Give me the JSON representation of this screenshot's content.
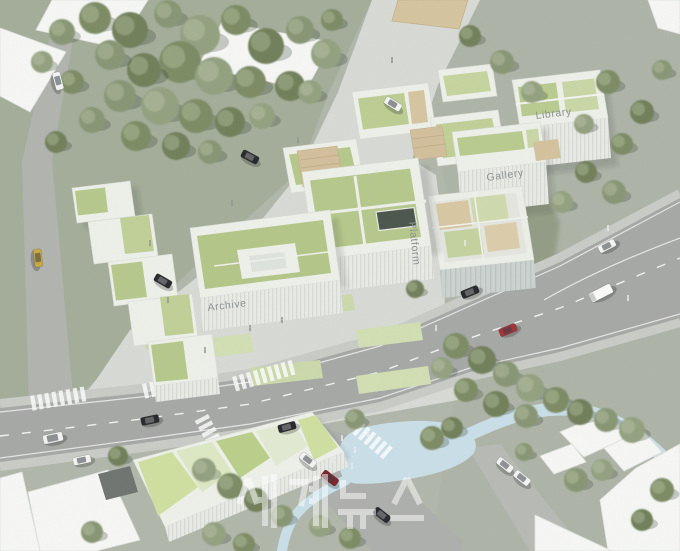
{
  "labels": {
    "library": "Library",
    "gallery": "Gallery",
    "platform": "Platform",
    "archive": "Archive"
  },
  "watermark": {
    "text": "세계뉴스",
    "color": "#ffffff"
  },
  "palette": {
    "ground": "#b2b8ac",
    "grass_upper_left": "#a3ad99",
    "plaza_paving": "#d8dad5",
    "asphalt": "#a6a8a6",
    "water": "#c9dfe8",
    "roof_green": "#b5c88a",
    "roof_green_light": "#cfe0a0",
    "building_white": "#f7f8f6",
    "wood_deck": "#d3c29c",
    "tree_green": "#7b8a64",
    "car_red": "#a33036",
    "car_dark_red": "#7d2127",
    "car_yellow": "#c8a83e",
    "label_gray": "#8c9190",
    "watermark_white": "#ffffff"
  },
  "scene": {
    "trees": [
      [
        95,
        18,
        16
      ],
      [
        130,
        30,
        18
      ],
      [
        168,
        14,
        14
      ],
      [
        200,
        35,
        20
      ],
      [
        236,
        20,
        15
      ],
      [
        266,
        46,
        18
      ],
      [
        300,
        30,
        14
      ],
      [
        326,
        54,
        15
      ],
      [
        180,
        62,
        21
      ],
      [
        144,
        70,
        17
      ],
      [
        110,
        55,
        15
      ],
      [
        214,
        76,
        19
      ],
      [
        250,
        82,
        16
      ],
      [
        290,
        86,
        15
      ],
      [
        120,
        96,
        16
      ],
      [
        160,
        106,
        19
      ],
      [
        196,
        116,
        17
      ],
      [
        230,
        122,
        15
      ],
      [
        92,
        120,
        13
      ],
      [
        262,
        116,
        13
      ],
      [
        136,
        136,
        15
      ],
      [
        176,
        146,
        14
      ],
      [
        62,
        32,
        13
      ],
      [
        42,
        62,
        11
      ],
      [
        72,
        82,
        12
      ],
      [
        56,
        142,
        11
      ],
      [
        210,
        152,
        12
      ],
      [
        310,
        92,
        12
      ],
      [
        332,
        20,
        11
      ],
      [
        470,
        36,
        11
      ],
      [
        502,
        62,
        12
      ],
      [
        532,
        92,
        11
      ],
      [
        608,
        82,
        12
      ],
      [
        642,
        112,
        12
      ],
      [
        662,
        70,
        10
      ],
      [
        584,
        124,
        10
      ],
      [
        622,
        144,
        11
      ],
      [
        586,
        172,
        11
      ],
      [
        614,
        192,
        12
      ],
      [
        562,
        202,
        11
      ],
      [
        456,
        346,
        13
      ],
      [
        482,
        360,
        14
      ],
      [
        506,
        374,
        13
      ],
      [
        530,
        388,
        14
      ],
      [
        556,
        400,
        13
      ],
      [
        580,
        412,
        13
      ],
      [
        606,
        420,
        12
      ],
      [
        632,
        430,
        13
      ],
      [
        466,
        390,
        12
      ],
      [
        496,
        404,
        13
      ],
      [
        526,
        416,
        12
      ],
      [
        442,
        368,
        11
      ],
      [
        432,
        438,
        12
      ],
      [
        452,
        428,
        11
      ],
      [
        576,
        480,
        12
      ],
      [
        602,
        470,
        11
      ],
      [
        662,
        490,
        12
      ],
      [
        642,
        520,
        11
      ],
      [
        524,
        452,
        9
      ],
      [
        204,
        470,
        12
      ],
      [
        230,
        486,
        13
      ],
      [
        256,
        500,
        12
      ],
      [
        282,
        516,
        11
      ],
      [
        320,
        526,
        11
      ],
      [
        350,
        538,
        11
      ],
      [
        118,
        456,
        10
      ],
      [
        92,
        532,
        11
      ],
      [
        214,
        534,
        12
      ],
      [
        244,
        544,
        11
      ],
      [
        415,
        289,
        9
      ],
      [
        355,
        419,
        10
      ]
    ],
    "cars": [
      [
        393,
        104,
        32,
        "white",
        "car"
      ],
      [
        250,
        157,
        28,
        "black",
        "car"
      ],
      [
        163,
        281,
        30,
        "black",
        "car"
      ],
      [
        38,
        258,
        83,
        "yellow",
        "car"
      ],
      [
        58,
        81,
        75,
        "white",
        "car"
      ],
      [
        607,
        246,
        -27,
        "white",
        "car"
      ],
      [
        601,
        293,
        -27,
        "white",
        "truck"
      ],
      [
        470,
        292,
        -22,
        "black",
        "car"
      ],
      [
        508,
        330,
        -22,
        "red",
        "car"
      ],
      [
        150,
        420,
        -12,
        "black",
        "car"
      ],
      [
        287,
        427,
        -15,
        "black",
        "car"
      ],
      [
        53,
        438,
        -12,
        "white",
        "van"
      ],
      [
        82,
        460,
        -12,
        "white",
        "car"
      ],
      [
        308,
        460,
        38,
        "white",
        "car"
      ],
      [
        330,
        478,
        38,
        "darkred",
        "car"
      ],
      [
        382,
        515,
        38,
        "black",
        "car"
      ],
      [
        505,
        465,
        38,
        "white",
        "car"
      ],
      [
        522,
        478,
        38,
        "white",
        "car"
      ]
    ],
    "people": [
      [
        150,
        245,
        1
      ],
      [
        168,
        302,
        1
      ],
      [
        205,
        352,
        1
      ],
      [
        232,
        205,
        1
      ],
      [
        298,
        142,
        1
      ],
      [
        392,
        62,
        1
      ],
      [
        424,
        232,
        0
      ],
      [
        465,
        245,
        0
      ],
      [
        250,
        330,
        1
      ],
      [
        282,
        322,
        1
      ],
      [
        342,
        440,
        0
      ],
      [
        355,
        452,
        0
      ],
      [
        368,
        436,
        0
      ],
      [
        332,
        462,
        0
      ],
      [
        352,
        468,
        0
      ],
      [
        608,
        230,
        0
      ],
      [
        436,
        330,
        0
      ],
      [
        628,
        300,
        0
      ]
    ],
    "crosswalks": [
      {
        "x": 30,
        "y": 396,
        "a": -10,
        "n": 8
      },
      {
        "x": 142,
        "y": 384,
        "a": -12,
        "n": 8
      },
      {
        "x": 232,
        "y": 377,
        "a": -16,
        "n": 9
      },
      {
        "x": 208,
        "y": 414,
        "a": 62,
        "n": 6
      },
      {
        "x": 362,
        "y": 422,
        "a": 40,
        "n": 6
      }
    ]
  }
}
